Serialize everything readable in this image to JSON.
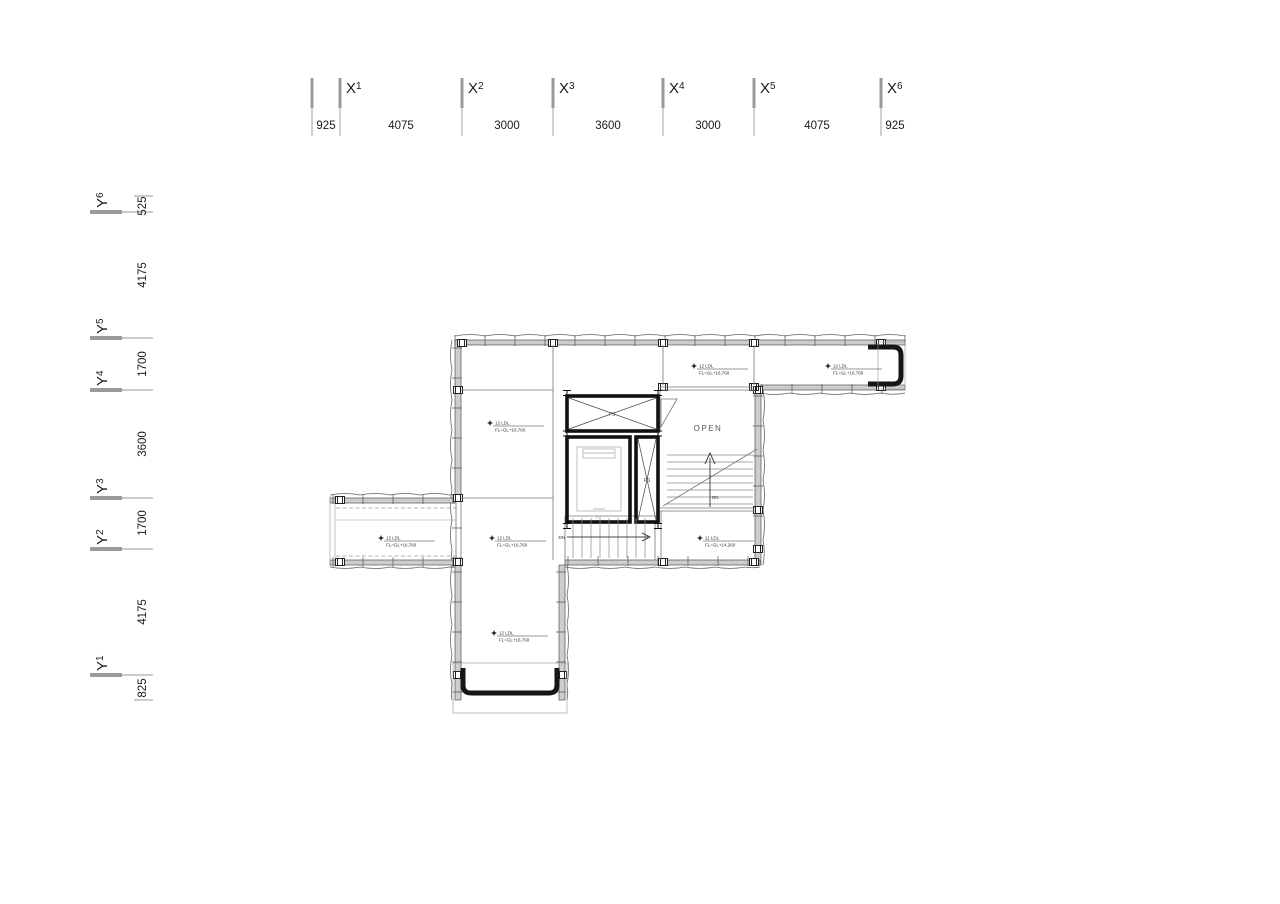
{
  "axes": {
    "x_labels": [
      {
        "letter": "X",
        "num": "1"
      },
      {
        "letter": "X",
        "num": "2"
      },
      {
        "letter": "X",
        "num": "3"
      },
      {
        "letter": "X",
        "num": "4"
      },
      {
        "letter": "X",
        "num": "5"
      },
      {
        "letter": "X",
        "num": "6"
      }
    ],
    "x_dims": [
      "925",
      "4075",
      "3000",
      "3600",
      "3000",
      "4075",
      "925"
    ],
    "y_labels": [
      {
        "letter": "Y",
        "num": "6"
      },
      {
        "letter": "Y",
        "num": "5"
      },
      {
        "letter": "Y",
        "num": "4"
      },
      {
        "letter": "Y",
        "num": "3"
      },
      {
        "letter": "Y",
        "num": "2"
      },
      {
        "letter": "Y",
        "num": "1"
      }
    ],
    "y_dims": [
      "525",
      "4175",
      "1700",
      "3600",
      "1700",
      "4175",
      "825"
    ]
  },
  "plan": {
    "open_label": "OPEN",
    "stair_down_label": "DN",
    "shaft_label_top": "PS",
    "shaft_label_right": "PS",
    "elevator_label": "EV",
    "room_labels": [
      {
        "line1": "12 LDL",
        "line2": "FL=GL+16,760"
      },
      {
        "line1": "12 LDL",
        "line2": "FL=GL+16,760"
      },
      {
        "line1": "12 LDL",
        "line2": "FL=GL+16,760"
      },
      {
        "line1": "12 LDL",
        "line2": "FL=GL+16,760"
      },
      {
        "line1": "12 LDL",
        "line2": "FL=GL+16,760"
      },
      {
        "line1": "12 LDL",
        "line2": "FL=GL+16,760"
      },
      {
        "line1": "11 LDL",
        "line2": "FL=GL+14,260"
      }
    ]
  }
}
